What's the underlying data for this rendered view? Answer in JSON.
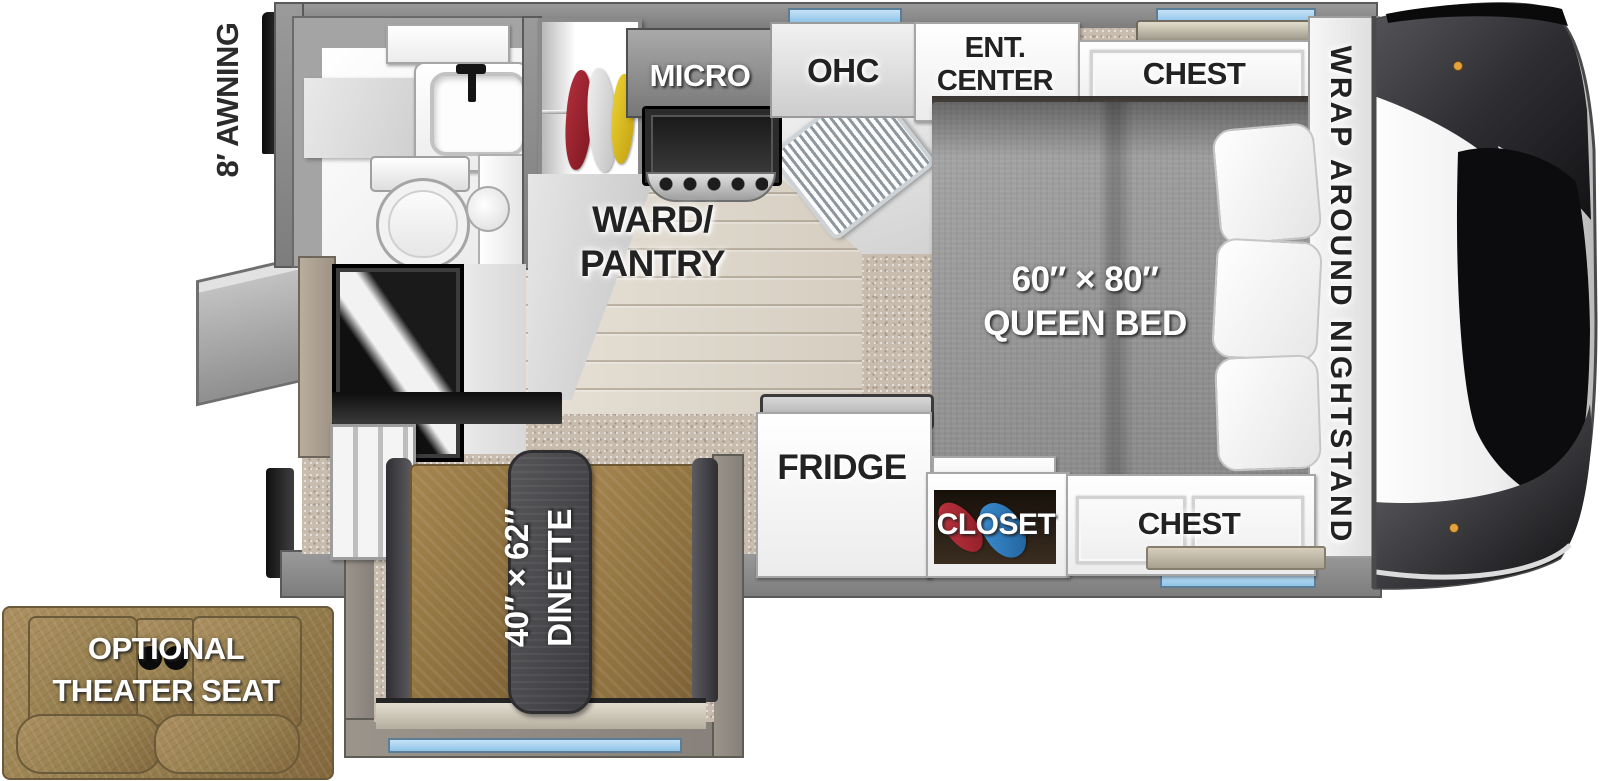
{
  "labels": {
    "awning": "8′ AWNING",
    "micro": "MICRO",
    "ohc": "OHC",
    "ent_center": [
      "ENT.",
      "CENTER"
    ],
    "chest_top": "CHEST",
    "nightstand": "WRAP AROUND NIGHTSTAND",
    "ward_pantry": [
      "WARD/",
      "PANTRY"
    ],
    "queen_bed": [
      "60″ × 80″",
      "QUEEN BED"
    ],
    "fridge": "FRIDGE",
    "closet": "CLOSET",
    "chest_bottom": "CHEST",
    "dinette": [
      "40″ × 62″",
      "DINETTE"
    ],
    "theater_seat": [
      "OPTIONAL",
      "THEATER SEAT"
    ]
  },
  "colors": {
    "window_accent": "#a9d3f1",
    "tv_accent": "#2f5fb5",
    "wall_gray": "#8e8e8e",
    "carpet_tan": "#c8bcae",
    "wood_floor": "#ded6c8",
    "bed_gray": "#989898",
    "dinette_brown": "#97783f",
    "theater_brown": "#9c8255",
    "wardrobe_clothes": [
      "#a32430",
      "#e8e8e8",
      "#e0c228"
    ],
    "closet_clothes": [
      "#b22e35",
      "#2f86c8"
    ]
  }
}
